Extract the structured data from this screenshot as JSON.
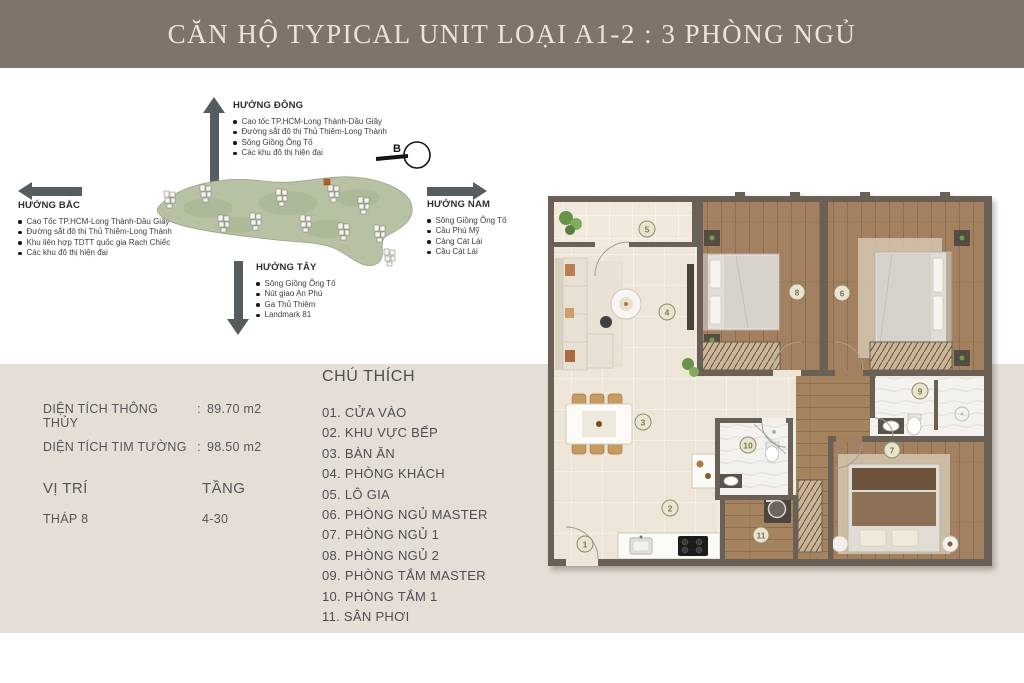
{
  "header": {
    "title": "CĂN HỘ TYPICAL UNIT LOẠI A1-2 : 3 PHÒNG NGỦ"
  },
  "compass": {
    "north_letter": "B",
    "east": {
      "title": "HƯỚNG ĐÔNG",
      "items": [
        "Cao tốc TP.HCM-Long Thành-Dầu Giây",
        "Đường sắt đô thị Thủ Thiêm-Long Thành",
        "Sông Giồng Ông Tố",
        "Các khu đô thị hiện đại"
      ]
    },
    "north": {
      "title": "HƯỚNG BẮC",
      "items": [
        "Cao Tốc TP.HCM-Long Thành-Dầu Giây",
        "Đường sắt đô thị Thủ Thiêm-Long Thành",
        "Khu liên hợp TDTT quốc gia Rạch Chiếc",
        "Các khu đô thị hiện đại"
      ]
    },
    "south": {
      "title": "HƯỚNG NAM",
      "items": [
        "Sông Giồng Ông Tố",
        "Cầu Phú Mỹ",
        "Cảng Cát Lái",
        "Cầu Cát Lái"
      ]
    },
    "west": {
      "title": "HƯỚNG TÂY",
      "items": [
        "Sông Giồng Ông Tố",
        "Nút giao An Phú",
        "Ga Thủ Thiêm",
        "Landmark 81"
      ]
    }
  },
  "info": {
    "rows": [
      {
        "label": "DIỆN TÍCH THÔNG THỦY",
        "sep": ":",
        "value": "89.70 m2"
      },
      {
        "label": "DIỆN TÍCH TIM TƯỜNG",
        "sep": ":",
        "value": "98.50 m2"
      }
    ],
    "position_label": "VỊ TRÍ",
    "floor_label": "TẦNG",
    "position_value": "THÁP 8",
    "floor_value": "4-30"
  },
  "legend": {
    "title": "CHÚ THÍCH",
    "items": [
      "01. CỬA VÀO",
      "02. KHU VỰC BẾP",
      "03. BÀN ĂN",
      "04. PHÒNG KHÁCH",
      "05. LÔ GIA",
      "06. PHÒNG NGỦ MASTER",
      "07. PHÒNG NGỦ 1",
      "08. PHÒNG NGỦ 2",
      "09. PHÒNG TẮM MASTER",
      "10. PHÒNG TẮM 1",
      "11. SÂN PHƠI"
    ]
  },
  "floor_plan": {
    "markers": [
      {
        "n": "1",
        "x": 45,
        "y": 352
      },
      {
        "n": "2",
        "x": 130,
        "y": 316
      },
      {
        "n": "3",
        "x": 103,
        "y": 230
      },
      {
        "n": "4",
        "x": 127,
        "y": 120
      },
      {
        "n": "5",
        "x": 107,
        "y": 37
      },
      {
        "n": "6",
        "x": 302,
        "y": 101
      },
      {
        "n": "7",
        "x": 352,
        "y": 258
      },
      {
        "n": "8",
        "x": 257,
        "y": 100
      },
      {
        "n": "9",
        "x": 380,
        "y": 199
      },
      {
        "n": "10",
        "x": 208,
        "y": 253
      },
      {
        "n": "11",
        "x": 221,
        "y": 343
      }
    ]
  },
  "colors": {
    "header_bg": "#7f746b",
    "header_text": "#ece4d6",
    "panel_bg": "#e4ded6",
    "arrow": "#565d60",
    "wall": "#6a6056",
    "wood_floor": "#a3805f",
    "tile_floor": "#ece5d8",
    "site_green": "#b6c2a3",
    "highlight_tower": "#b35c30",
    "marker_ring": "#8f8f63"
  }
}
